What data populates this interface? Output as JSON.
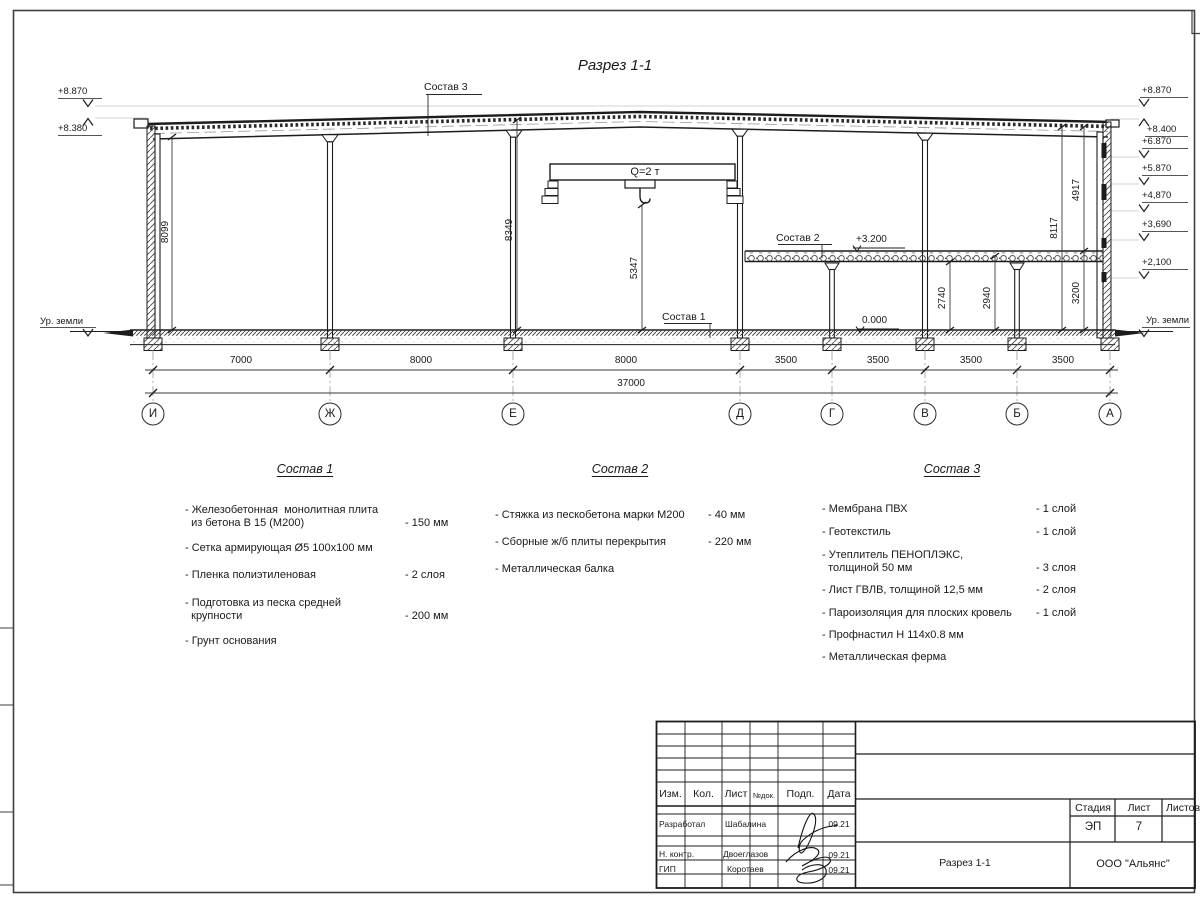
{
  "drawing": {
    "title": "Разрез 1-1",
    "crane_label": "Q=2 т",
    "callout1": "Состав 1",
    "callout2": "Состав 2",
    "callout3": "Состав 3",
    "ground_label_left": "Ур. земли",
    "ground_label_right": "Ур. земли",
    "elev_left": [
      "+8.870",
      "+8.380"
    ],
    "elev_right": [
      "+8.870",
      "+8.400",
      "+6.870",
      "+5.870",
      "+4,870",
      "+3,690",
      "+2,100"
    ],
    "elev_internal": [
      "+3.200",
      "0.000"
    ],
    "vdims": [
      "8099",
      "8349",
      "5347",
      "2740",
      "2940",
      "3200",
      "8117",
      "4917"
    ],
    "spans": [
      "7000",
      "8000",
      "8000",
      "3500",
      "3500",
      "3500",
      "3500"
    ],
    "total_span": "37000",
    "axes": [
      "И",
      "Ж",
      "Е",
      "Д",
      "Г",
      "В",
      "Б",
      "А"
    ]
  },
  "compositions": [
    {
      "title": "Состав 1",
      "items": [
        {
          "name": "- Железобетонная  монолитная плита\n  из бетона В 15 (М200)",
          "value": "- 150 мм"
        },
        {
          "name": "- Сетка армирующая Ø5 100x100 мм",
          "value": ""
        },
        {
          "name": "- Пленка полиэтиленовая",
          "value": "-  2 слоя"
        },
        {
          "name": "- Подготовка из песка средней\n  крупности",
          "value": "- 200 мм"
        },
        {
          "name": "- Грунт основания",
          "value": ""
        }
      ]
    },
    {
      "title": "Состав 2",
      "items": [
        {
          "name": "- Стяжка из пескобетона марки М200",
          "value": "- 40 мм"
        },
        {
          "name": "- Сборные ж/б плиты перекрытия",
          "value": "- 220 мм"
        },
        {
          "name": "- Металлическая балка",
          "value": ""
        }
      ]
    },
    {
      "title": "Состав 3",
      "items": [
        {
          "name": "- Мембрана ПВХ",
          "value": "- 1 слой"
        },
        {
          "name": "- Геотекстиль",
          "value": "- 1 слой"
        },
        {
          "name": "- Утеплитель ПЕНОПЛЭКС,\n  толщиной 50 мм",
          "value": "- 3 слоя"
        },
        {
          "name": "- Лист ГВЛВ, толщиной 12,5 мм",
          "value": "- 2 слоя"
        },
        {
          "name": "- Пароизоляция для плоских кровель",
          "value": "- 1 слой"
        },
        {
          "name": "- Профнастил Н 114x0.8 мм",
          "value": ""
        },
        {
          "name": "- Металлическая ферма",
          "value": ""
        }
      ]
    }
  ],
  "titleblock": {
    "header": [
      "Изм.",
      "Кол.",
      "Лист",
      "№док.",
      "Подп.",
      "Дата"
    ],
    "rows": [
      {
        "role": "Разработал",
        "name": "Шабалина",
        "date": "09.21"
      },
      {
        "role": "Н. контр.",
        "name": "Двоеглазов",
        "date": "09.21"
      },
      {
        "role": "ГИП",
        "name": "Коротаев",
        "date": "09.21"
      }
    ],
    "stage_label": "Стадия",
    "sheet_label": "Лист",
    "sheets_label": "Листов",
    "stage_value": "ЭП",
    "sheet_value": "7",
    "sheets_value": "",
    "doc_name": "Разрез 1-1",
    "company": "ООО \"Альянс\""
  }
}
